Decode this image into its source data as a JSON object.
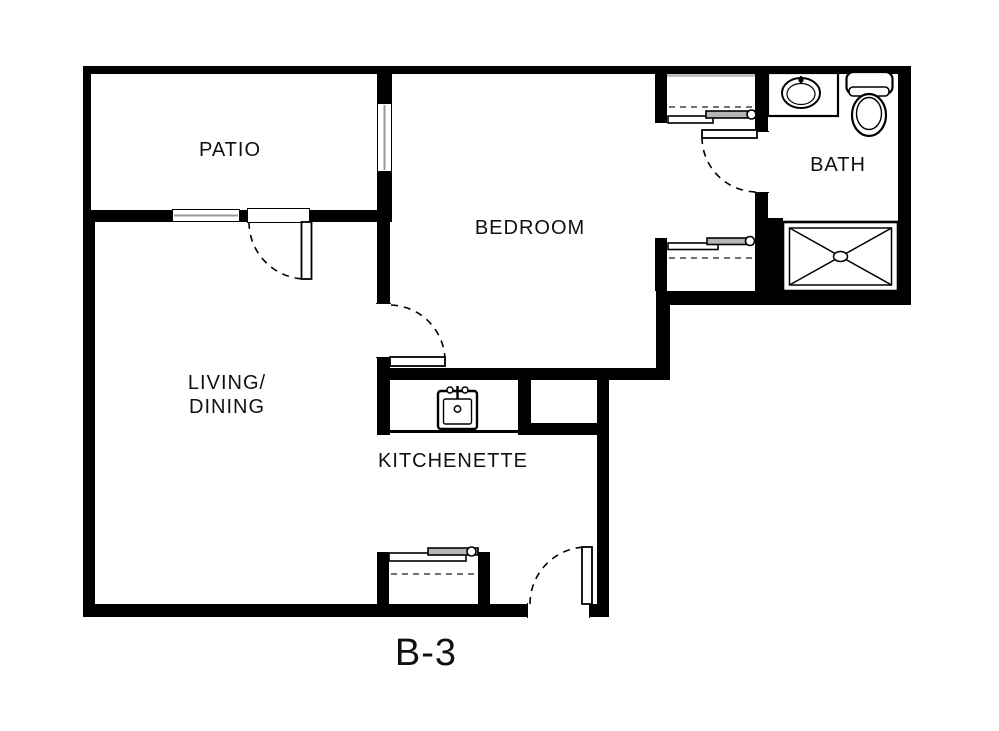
{
  "title": "Floor plan unit B-3",
  "colors": {
    "wall": "#000000",
    "background": "#ffffff",
    "panel_gray": "#b5b5b5",
    "glass_gray": "#9a9a9a",
    "text": "#111111"
  },
  "labels": {
    "patio": "PATIO",
    "bedroom": "BEDROOM",
    "bath": "BATH",
    "living_line1": "LIVING/",
    "living_line2": "DINING",
    "kitchenette": "KITCHENETTE",
    "plan_code": "B-3"
  },
  "fixtures": [
    "kitchen-sink",
    "bathroom-sink-vanity",
    "toilet",
    "shower-pan",
    "sliding-closet-doors-bedroom-upper",
    "sliding-closet-doors-bedroom-lower",
    "sliding-closet-doors-entry",
    "swing-door-patio",
    "swing-door-bedroom",
    "swing-door-bath",
    "swing-door-entry",
    "window-patio",
    "window-bedroom"
  ]
}
